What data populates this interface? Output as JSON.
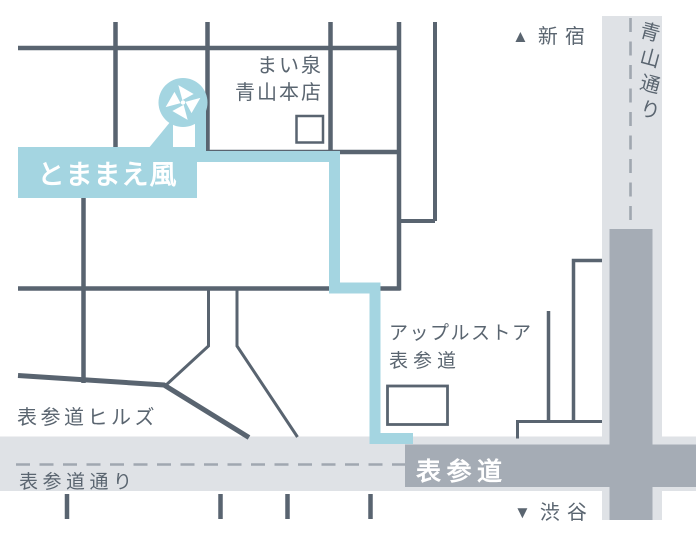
{
  "destination_callout": {
    "label": "とままえ風"
  },
  "map_pin": {
    "icon": "pinwheel-icon"
  },
  "landmarks": {
    "maisen": {
      "line1": "まい泉",
      "line2": "青山本店"
    },
    "apple_store": {
      "line1": "アップルストア",
      "line2": "表参道"
    },
    "omotesando_hills": {
      "label": "表参道ヒルズ"
    }
  },
  "roads": {
    "aoyama_dori": {
      "label": "青山通り"
    },
    "omotesando_dori": {
      "label": "表参道通り"
    },
    "omotesando_avenue": {
      "label": "表参道"
    }
  },
  "directions": {
    "north": {
      "arrow": "▲",
      "label": "新宿"
    },
    "south": {
      "arrow": "▼",
      "label": "渋谷"
    }
  },
  "colors": {
    "route_and_pin": "#a4d5e1",
    "road_and_text": "#596470",
    "road_band_light": "#dfe2e6",
    "road_band_dark": "#a5acb5",
    "centerline_dash": "#a0a7b0",
    "text_on_accent": "#ffffff"
  }
}
